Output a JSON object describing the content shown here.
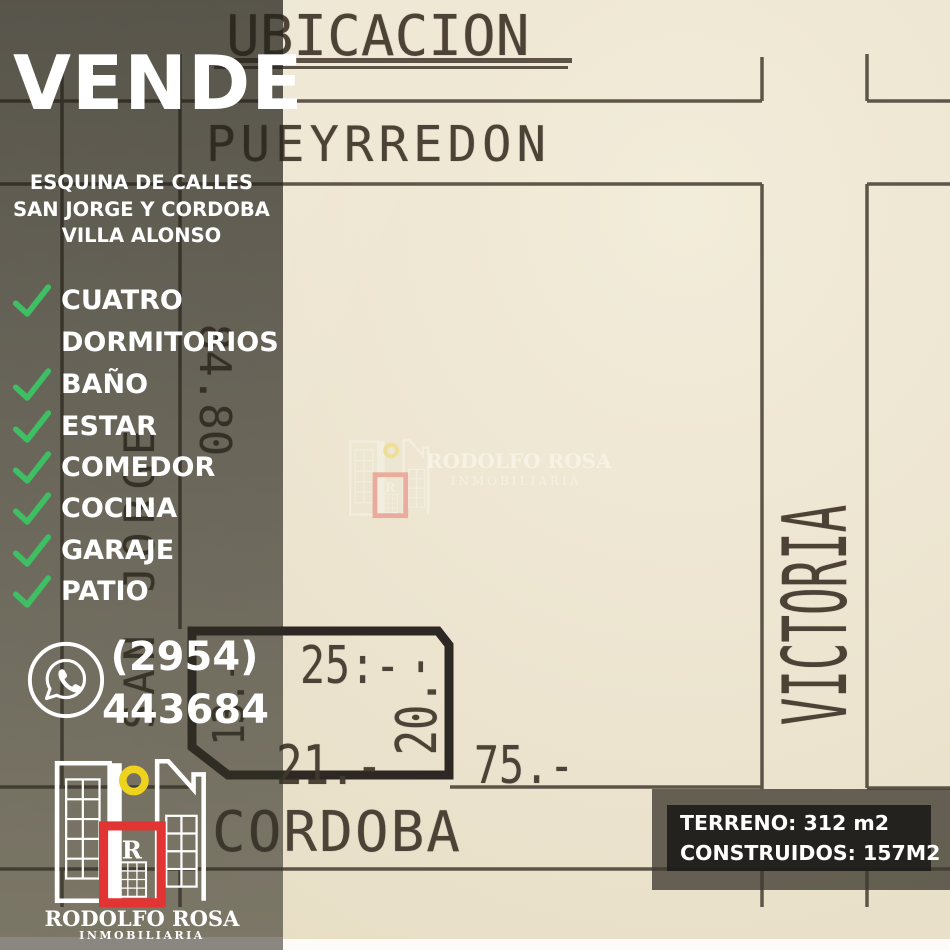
{
  "sidebar": {
    "title": "VENDE",
    "address_lines": [
      "ESQUINA DE CALLES",
      "SAN JORGE Y CORDOBA",
      "VILLA ALONSO"
    ],
    "features": [
      {
        "label": "CUATRO",
        "check": true
      },
      {
        "label": "DORMITORIOS",
        "check": false
      },
      {
        "label": "BAÑO",
        "check": true
      },
      {
        "label": "ESTAR",
        "check": true
      },
      {
        "label": "COMEDOR",
        "check": true
      },
      {
        "label": "COCINA",
        "check": true
      },
      {
        "label": "GARAJE",
        "check": true
      },
      {
        "label": "PATIO",
        "check": true
      }
    ],
    "phone": {
      "area_code": "(2954)",
      "number": "443684"
    },
    "brand": {
      "name": "RODOLFO ROSA",
      "tagline": "INMOBILIARIA"
    }
  },
  "map": {
    "title": "UBICACION",
    "streets": {
      "top": "PUEYRREDON",
      "left": "SAN JORGE",
      "right": "VICTORIA",
      "bottom": "CORDOBA"
    },
    "measurements": {
      "block_frontage": "84.80",
      "plot_top": "25:-",
      "plot_right": "20.-",
      "plot_bottom": "21.-",
      "plot_left": "13.-",
      "cordoba_frontage": "75.-"
    }
  },
  "watermark": {
    "name": "RODOLFO ROSA",
    "tagline": "INMOBILIARIA"
  },
  "info_box": {
    "terreno": "TERRENO: 312 m2",
    "construidos": "CONSTRUIDOS: 157M2"
  },
  "colors": {
    "check_green": "#3fbf63",
    "brand_red": "#e23432",
    "brand_yellow": "#eed31e",
    "paper": "#ece4cf",
    "ink": "#4a4136",
    "overlay_olive": "#6a6455"
  }
}
